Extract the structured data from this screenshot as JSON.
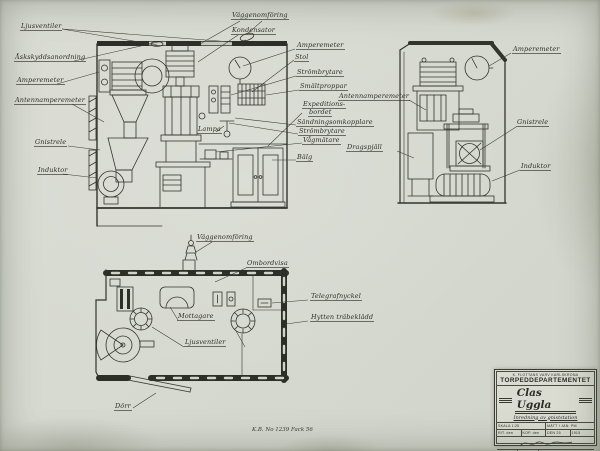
{
  "colors": {
    "ink": "#34342e",
    "paper": "#d6d9d0"
  },
  "labels": {
    "ljusventiler": "Ljusventiler",
    "askskyddsanordning": "Åskskyddsanordning",
    "amperemeter_left": "Amperemeter",
    "antennamperemeter_left": "Antennamperemeter",
    "gnistrele_left": "Gnistrele",
    "induktor_left": "Induktor",
    "vaggenomforing_top": "Väggenomföring",
    "kondensator": "Kondensator",
    "amperemeter_mid": "Amperemeter",
    "stol": "Stol",
    "strombrytare_1": "Strömbrytare",
    "smaltproppar": "Smältproppar",
    "expeditions_1": "Expeditions-",
    "expeditions_2": "bordet",
    "sandningsomkopplare": "Sändningsomkopplare",
    "strombrytare_2": "Strömbrytare",
    "vagmatare": "Vågmätare",
    "balg": "Bälg",
    "antennamperemeter_right": "Antennamperemeter",
    "dragspjall": "Dragspjäll",
    "amperemeter_right": "Amperemeter",
    "gnistrele_right": "Gnistrele",
    "induktor_right": "Induktor",
    "lampa": "Lampa",
    "vaggenomforing_plan": "Väggenomföring",
    "ombordvisa": "Ombordvisa",
    "mottagare": "Mottagare",
    "ljusventiler_plan": "Ljusventiler",
    "telegrafnyckel": "Telegrafnyckel",
    "hytten_trabekladd": "Hytten träbeklädd",
    "dorr": "Dörr"
  },
  "title_block": {
    "org": "K. FLOTTANS VARV KARLSKRONA",
    "department": "TORPEDDEPARTEMENTET",
    "ship_name": "Clas Uggla",
    "subtitle": "Inredning av gniststation",
    "scale": "SKALA 1:25",
    "measure": "MÄTT I JAN. PM",
    "rit": "RIT. den",
    "kop": "KOP. den",
    "den": "DEN 25",
    "year": "1915",
    "cell_left": "K.L.",
    "cell_mid": "70 %",
    "drawing_number": "H 1100"
  },
  "annotations": {
    "archive_note": "K.B. No 1239 Fack 56"
  }
}
